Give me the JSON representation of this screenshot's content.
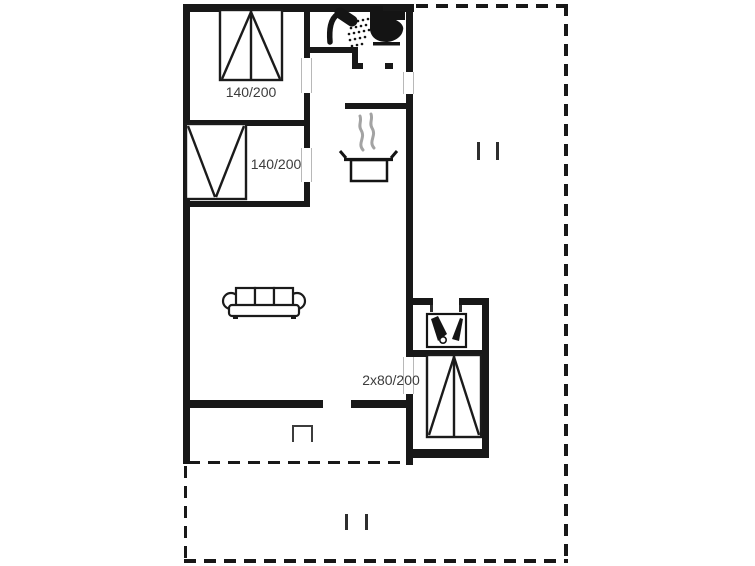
{
  "page": {
    "background": "#ffffff"
  },
  "floorplan": {
    "type": "holiday-home-floor-plan",
    "colors": {
      "wall": "#181818",
      "door_jamb": "#b8b8b8",
      "label": "#3c3c3c",
      "steam": "#a3a3a3",
      "furniture_stroke": "#1b1b1b"
    },
    "labels": {
      "bedroom_top_bed": "140/200",
      "bedroom_left_bed": "140/200",
      "bedroom_right_bed": "2x80/200"
    },
    "icons": {
      "shower": "shower-icon",
      "toilet": "toilet-icon",
      "cooking_pot": "cooking-pot-icon",
      "steam": "steam-icon",
      "washbasin": "washbasin-icon",
      "sofa": "sofa-icon",
      "beds": "bed-icon",
      "terrace_step": "terrace-step-icon",
      "terrace_marks": "terrace-divider-marks"
    }
  }
}
